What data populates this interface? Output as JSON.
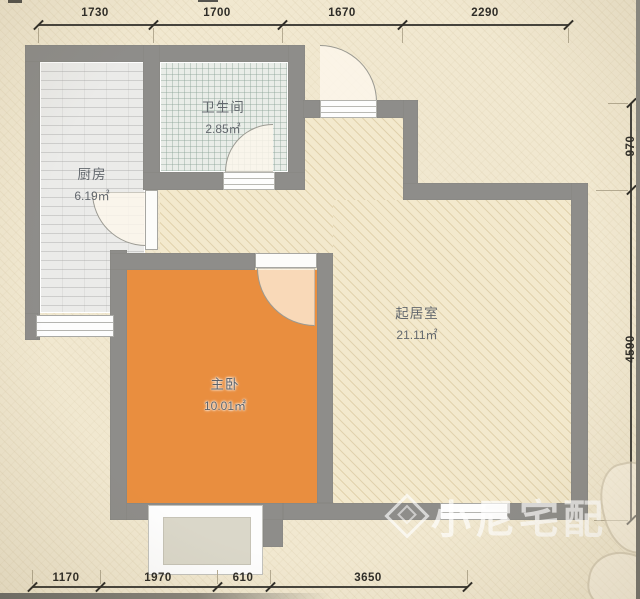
{
  "plan": {
    "rooms": [
      {
        "id": "kitchen",
        "name": "厨房",
        "area": "6.19㎡"
      },
      {
        "id": "bathroom",
        "name": "卫生间",
        "area": "2.85㎡"
      },
      {
        "id": "living",
        "name": "起居室",
        "area": "21.11㎡"
      },
      {
        "id": "bedroom",
        "name": "主卧",
        "area": "10.01㎡"
      }
    ],
    "dimensions": {
      "top": [
        "1730",
        "1700",
        "1670",
        "2290"
      ],
      "bottom": [
        "1170",
        "1970",
        "610",
        "3650"
      ],
      "right": [
        "970",
        "4590"
      ]
    },
    "watermark": {
      "text": "小尼宅配"
    },
    "colors": {
      "wall": "#8e8d8a",
      "paper": "#f1e8d0",
      "bedroom_floor": "#e98e3f",
      "living_floor": "#f3e9cd",
      "kitchen_floor": "#ebebe9",
      "bathroom_floor": "#e9ede8"
    }
  }
}
